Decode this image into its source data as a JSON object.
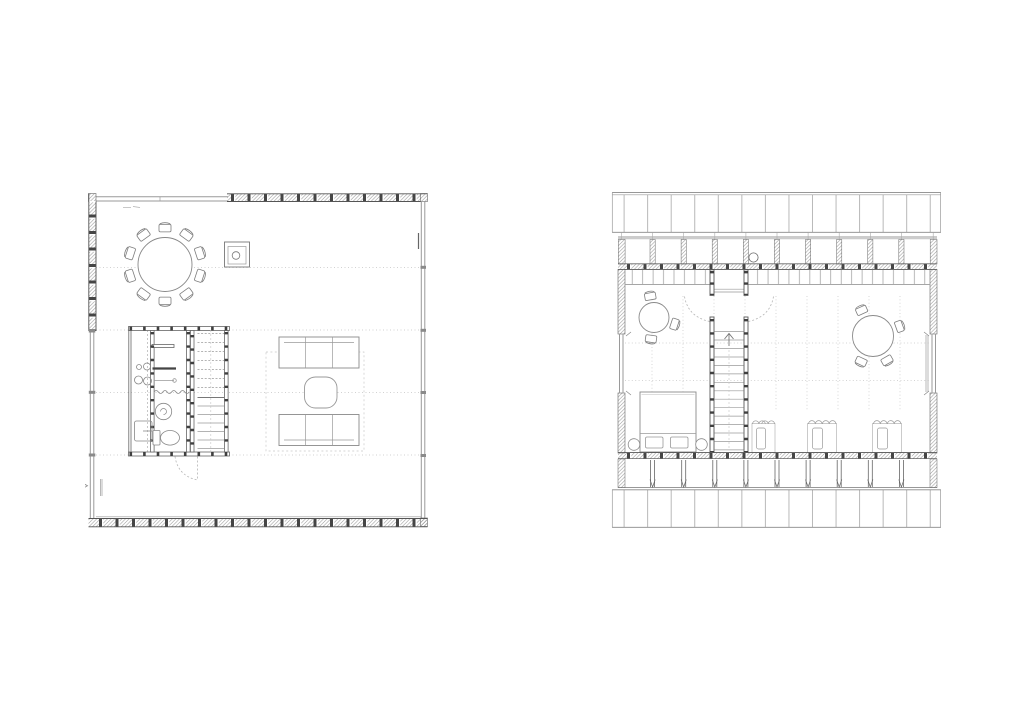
{
  "sheet": {
    "background": "#ffffff",
    "description": "Architectural drawing sheet with two floor plans in fine gray linework",
    "plans": [
      {
        "id": "ground-floor",
        "label": "Ground floor plan: open room with round dining table and ten chairs, wood stove, central service core with kitchen counter, shower and WC, straight stair, two facing sofas with coffee table, glazed south and east facades, insulated hatched walls",
        "position": "left",
        "furniture": [
          "dining-table",
          "chairs",
          "wood-stove",
          "kitchen-counter",
          "sink",
          "cooktop",
          "appliance",
          "shower",
          "toilet",
          "staircase",
          "sofa",
          "sofa",
          "coffee-table",
          "rug"
        ],
        "dining_chair_count": 10,
        "sofa_count": 2,
        "grid_lines_horizontal": 4
      },
      {
        "id": "upper-floor",
        "label": "Upper floor plan: attic level between two roof planes, central stair with up arrow and door swings, small round table with three chairs, large round table with four chairs, double bed with two side stools, three open wardrobes, gable windows left and right",
        "position": "right",
        "furniture": [
          "staircase-up",
          "round-table-small",
          "round-table-large",
          "chairs",
          "double-bed",
          "pillows",
          "side-stool",
          "side-stool",
          "wardrobe",
          "wardrobe",
          "wardrobe",
          "chimney"
        ],
        "small_table_chair_count": 3,
        "large_table_chair_count": 4,
        "wardrobe_count": 3,
        "roof_planes": 2
      }
    ]
  },
  "colors": {
    "background": "#ffffff",
    "line_dark": "#4f4f4f",
    "line_medium": "#777777",
    "line_light": "#9a9a9a",
    "furniture": "#8a8a8a",
    "stud": "#3f3f3f",
    "hatch": "#8c8c8c",
    "grid_dotted": "#c4c4c4",
    "dashed_swing": "#b5b5b5"
  }
}
